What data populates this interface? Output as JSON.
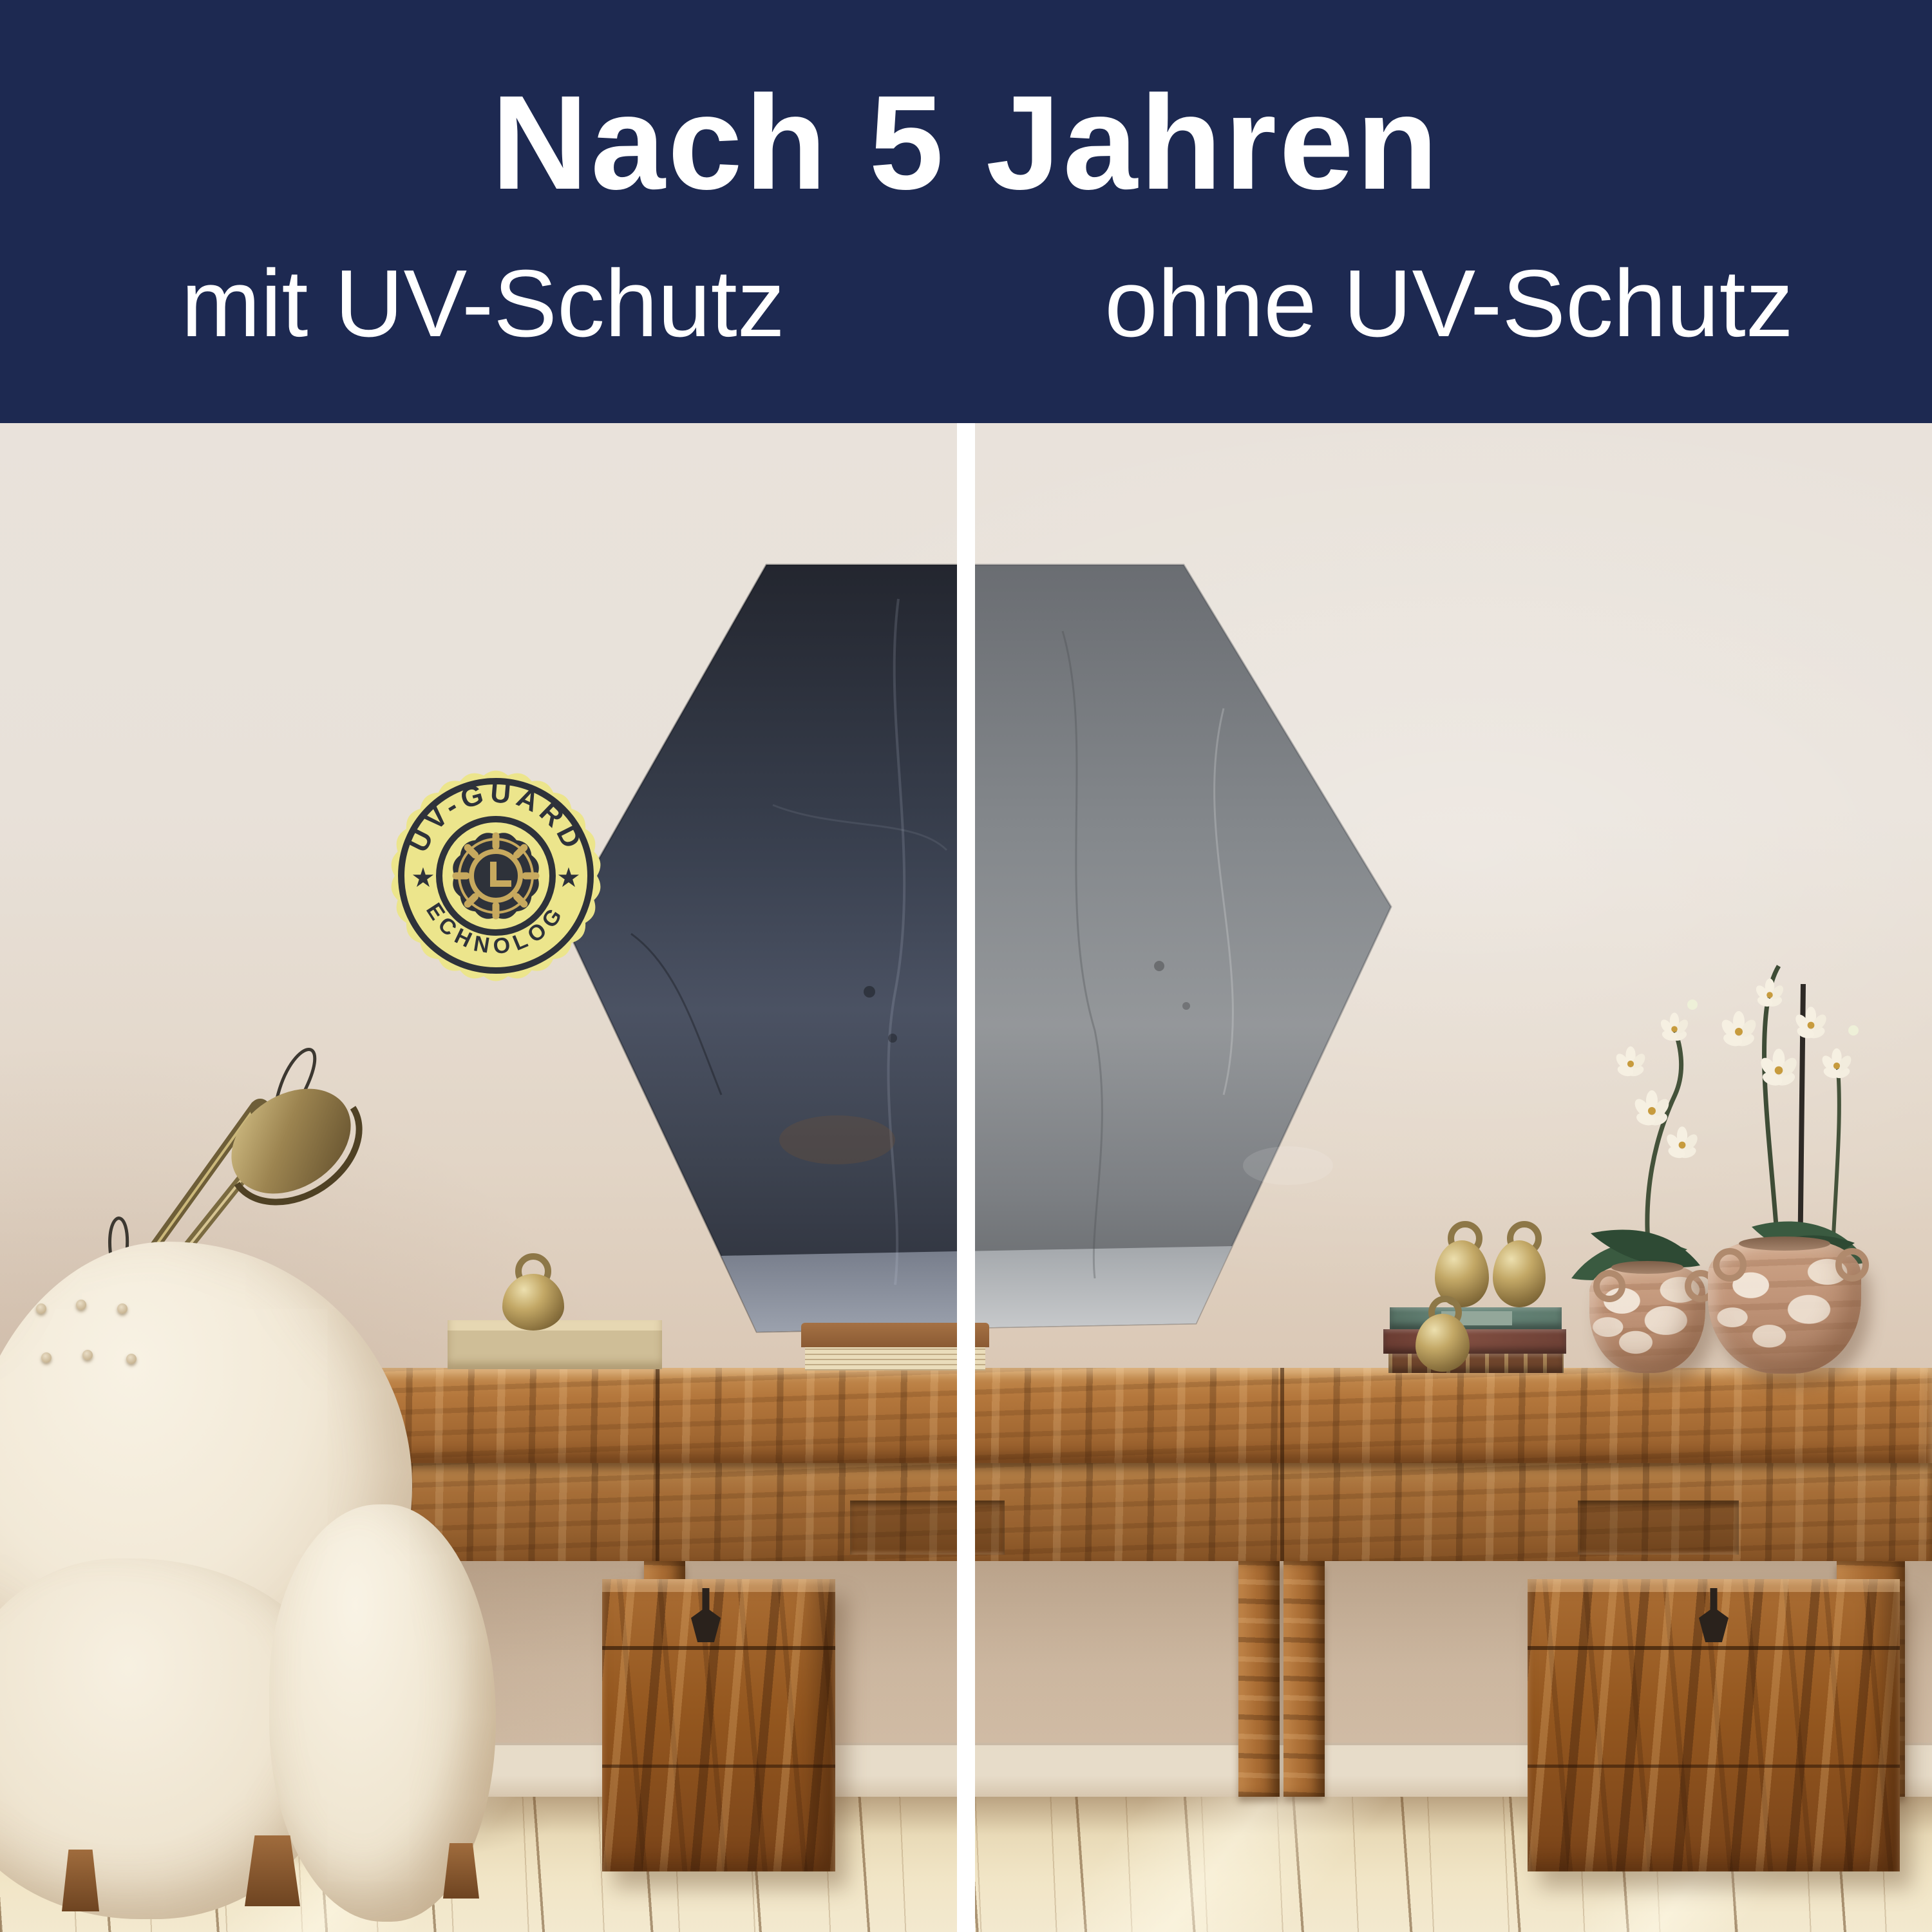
{
  "header": {
    "title": "Nach 5 Jahren",
    "left_label": "mit UV-Schutz",
    "right_label": "ohne UV-Schutz",
    "background_color": "#1d2951",
    "text_color": "#ffffff"
  },
  "badge": {
    "top_text": "UV-GUARD",
    "bottom_text": "TECHNOLOGY",
    "icon": "clock-gear-sun-icon",
    "background_color": "#ece58c",
    "foreground_color": "#2e323a",
    "gold_color": "#c7a95e"
  },
  "comparison": {
    "divider_color": "#ffffff",
    "artwork_shape": "hexagon",
    "artwork_left_tone": "#3a4150",
    "artwork_right_tone": "#85898e"
  },
  "scene_objects": [
    "hexagon-wall-art",
    "uv-guard-badge",
    "comparison-divider",
    "desk-lamp",
    "boucle-armchair",
    "console-table",
    "wooden-chest-left",
    "wooden-chest-right",
    "brass-bell",
    "wooden-tray",
    "book",
    "book-stack",
    "brass-weights",
    "terracotta-vase-small",
    "terracotta-vase-large",
    "white-orchids",
    "wood-floor"
  ]
}
